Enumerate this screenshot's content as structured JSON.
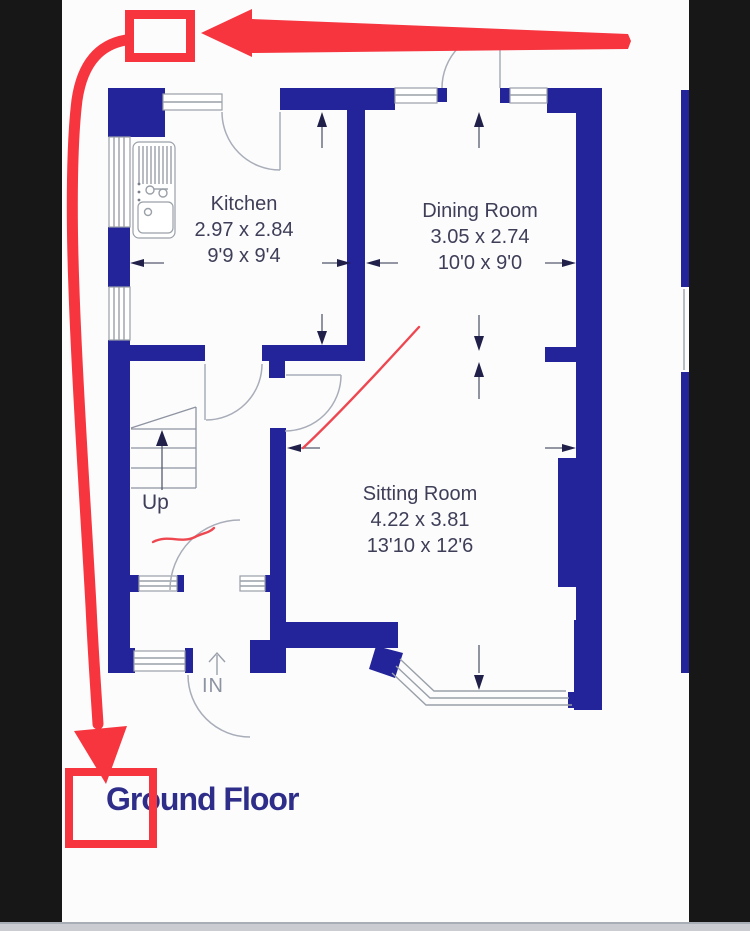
{
  "floorplan": {
    "title": "Ground Floor",
    "rooms": [
      {
        "name": "Kitchen",
        "metric": "2.97 x 2.84",
        "imperial": "9'9 x 9'4"
      },
      {
        "name": "Dining Room",
        "metric": "3.05 x 2.74",
        "imperial": "10'0 x 9'0"
      },
      {
        "name": "Sitting Room",
        "metric": "4.22 x 3.81",
        "imperial": "13'10 x 12'6"
      }
    ],
    "stairs_label": "Up",
    "entrance_label": "IN"
  },
  "annotations": {
    "shapes": [
      "top-target-box",
      "left-to-top-arrow",
      "curved-arrow-to-title",
      "title-target-box",
      "thin-pointer-line",
      "pen-scribble"
    ]
  },
  "colors": {
    "wall": "#23239a",
    "annotation-red": "#f6353f",
    "annotation-red-thin": "#ee4750",
    "room-text": "#3e3e58",
    "title-text": "#2e2e8a",
    "line-gray": "#9aa0a8",
    "dim-arrow": "#20204a",
    "bar-black": "#171717",
    "canvas": "#fcfcfd",
    "footer-gray": "#caccd1"
  }
}
